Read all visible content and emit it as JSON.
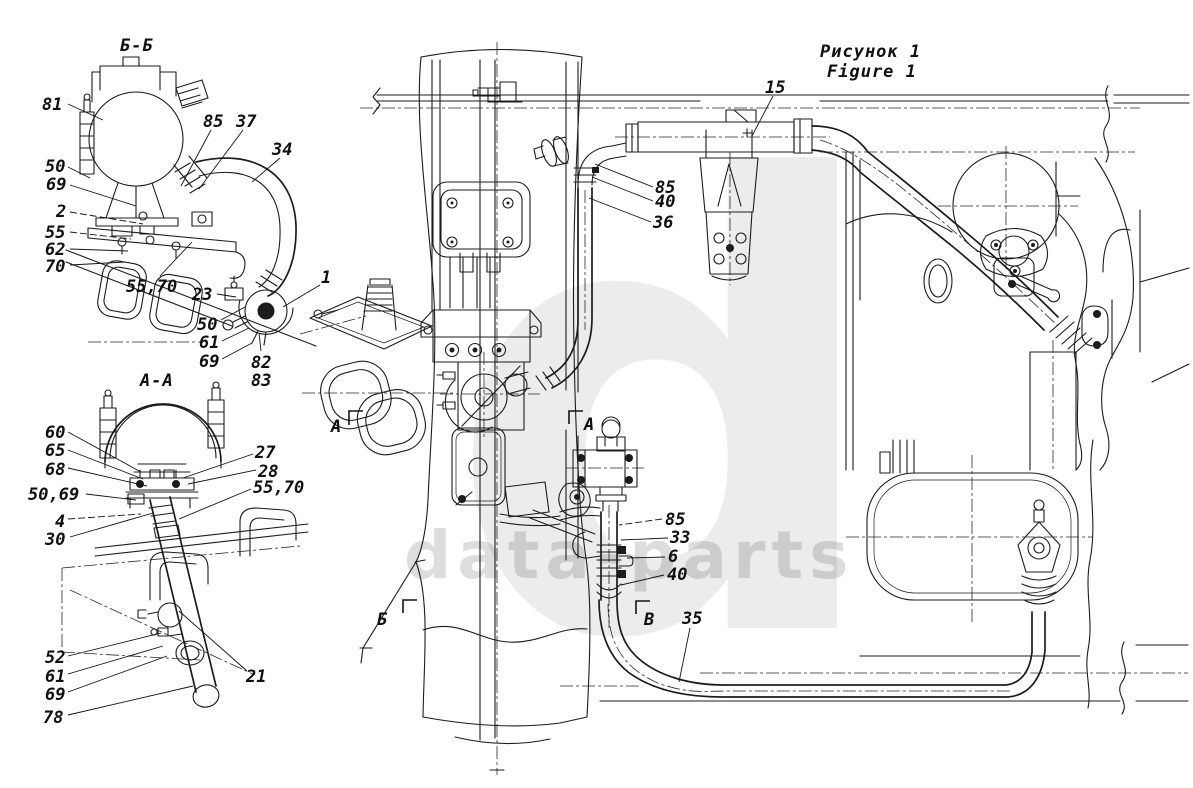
{
  "figure": {
    "title_ru": "Рисунок 1",
    "title_en": "Figure 1"
  },
  "watermark": {
    "letter": "d",
    "text": "data-parts"
  },
  "sections": {
    "bb": "Б-Б",
    "aa": "А-А"
  },
  "markers": [
    {
      "label": "А",
      "x": 331,
      "y": 432,
      "bracket": [
        [
          349,
          425
        ],
        [
          349,
          411
        ],
        [
          363,
          411
        ]
      ]
    },
    {
      "label": "А",
      "x": 584,
      "y": 430,
      "bracket": [
        [
          569,
          424
        ],
        [
          569,
          411
        ],
        [
          583,
          411
        ]
      ]
    },
    {
      "label": "Б",
      "x": 377,
      "y": 625,
      "bracket": [
        [
          403,
          613
        ],
        [
          403,
          600
        ],
        [
          417,
          600
        ]
      ]
    },
    {
      "label": "В",
      "x": 644,
      "y": 625,
      "bracket": [
        [
          636,
          614
        ],
        [
          636,
          601
        ],
        [
          650,
          601
        ]
      ]
    }
  ],
  "callouts": [
    {
      "t": "81",
      "x": 42,
      "y": 110,
      "leader": [
        [
          68,
          104
        ],
        [
          103,
          120
        ]
      ]
    },
    {
      "t": "85",
      "x": 203,
      "y": 127,
      "leader": [
        [
          211,
          130
        ],
        [
          181,
          186
        ]
      ]
    },
    {
      "t": "37",
      "x": 236,
      "y": 127,
      "leader": [
        [
          243,
          130
        ],
        [
          199,
          189
        ]
      ]
    },
    {
      "t": "34",
      "x": 272,
      "y": 155,
      "leader": [
        [
          280,
          158
        ],
        [
          252,
          182
        ]
      ]
    },
    {
      "t": "50",
      "x": 45,
      "y": 172,
      "leader": [
        [
          68,
          167
        ],
        [
          90,
          178
        ]
      ]
    },
    {
      "t": "69",
      "x": 46,
      "y": 190,
      "leader": [
        [
          70,
          185
        ],
        [
          136,
          206
        ]
      ]
    },
    {
      "t": "2",
      "x": 56,
      "y": 217,
      "leader": [
        [
          70,
          212
        ],
        [
          143,
          224
        ]
      ],
      "dash": true
    },
    {
      "t": "55",
      "x": 45,
      "y": 238,
      "leader": [
        [
          70,
          232
        ],
        [
          131,
          239
        ]
      ],
      "dash": true
    },
    {
      "t": "62",
      "x": 45,
      "y": 255,
      "leader": [
        [
          70,
          249
        ],
        [
          128,
          251
        ]
      ]
    },
    {
      "t": "70",
      "x": 45,
      "y": 272,
      "leader": [
        [
          70,
          265
        ],
        [
          126,
          262
        ]
      ]
    },
    {
      "t": "55,70",
      "x": 126,
      "y": 292,
      "leader": [
        [
          160,
          276
        ],
        [
          192,
          242
        ]
      ]
    },
    {
      "t": "23",
      "x": 192,
      "y": 300,
      "leader": [
        [
          217,
          294
        ],
        [
          236,
          297
        ]
      ]
    },
    {
      "t": "1",
      "x": 321,
      "y": 283,
      "leader": [
        [
          320,
          285
        ],
        [
          283,
          307
        ]
      ]
    },
    {
      "t": "50",
      "x": 197,
      "y": 330,
      "leader": [
        [
          221,
          320
        ],
        [
          245,
          307
        ]
      ]
    },
    {
      "t": "61",
      "x": 199,
      "y": 348,
      "leader": [
        [
          222,
          341
        ],
        [
          249,
          328
        ]
      ]
    },
    {
      "t": "69",
      "x": 199,
      "y": 367,
      "leader": [
        [
          222,
          359
        ],
        [
          252,
          343
        ]
      ]
    },
    {
      "t": "82",
      "x": 251,
      "y": 368,
      "leader": [
        [
          261,
          351
        ],
        [
          259,
          333
        ]
      ]
    },
    {
      "t": "83",
      "x": 251,
      "y": 386
    },
    {
      "t": "60",
      "x": 45,
      "y": 438,
      "leader": [
        [
          68,
          432
        ],
        [
          141,
          472
        ]
      ]
    },
    {
      "t": "65",
      "x": 45,
      "y": 456,
      "leader": [
        [
          68,
          450
        ],
        [
          143,
          479
        ]
      ]
    },
    {
      "t": "68",
      "x": 45,
      "y": 475,
      "leader": [
        [
          68,
          468
        ],
        [
          147,
          486
        ]
      ]
    },
    {
      "t": "50,69",
      "x": 28,
      "y": 500,
      "leader": [
        [
          86,
          494
        ],
        [
          136,
          500
        ]
      ]
    },
    {
      "t": "4",
      "x": 55,
      "y": 527,
      "leader": [
        [
          68,
          519
        ],
        [
          141,
          514
        ]
      ],
      "dash": true
    },
    {
      "t": "30",
      "x": 45,
      "y": 545,
      "leader": [
        [
          70,
          537
        ],
        [
          153,
          513
        ]
      ]
    },
    {
      "t": "27",
      "x": 255,
      "y": 458,
      "leader": [
        [
          253,
          454
        ],
        [
          183,
          478
        ]
      ]
    },
    {
      "t": "28",
      "x": 258,
      "y": 477,
      "leader": [
        [
          256,
          470
        ],
        [
          188,
          484
        ]
      ]
    },
    {
      "t": "55,70",
      "x": 253,
      "y": 493,
      "leader": [
        [
          251,
          489
        ],
        [
          179,
          519
        ]
      ]
    },
    {
      "t": "52",
      "x": 45,
      "y": 663,
      "leader": [
        [
          68,
          656
        ],
        [
          161,
          633
        ]
      ]
    },
    {
      "t": "61",
      "x": 45,
      "y": 682,
      "leader": [
        [
          68,
          674
        ],
        [
          163,
          646
        ]
      ]
    },
    {
      "t": "69",
      "x": 45,
      "y": 700,
      "leader": [
        [
          68,
          692
        ],
        [
          167,
          656
        ]
      ]
    },
    {
      "t": "78",
      "x": 43,
      "y": 723,
      "leader": [
        [
          68,
          715
        ],
        [
          193,
          686
        ]
      ]
    },
    {
      "t": "21",
      "x": 246,
      "y": 682,
      "leader": [
        [
          247,
          671
        ],
        [
          179,
          611
        ]
      ]
    },
    {
      "t": "15",
      "x": 765,
      "y": 93,
      "leader": [
        [
          773,
          96
        ],
        [
          752,
          136
        ]
      ]
    },
    {
      "t": "85",
      "x": 655,
      "y": 193,
      "leader": [
        [
          653,
          187
        ],
        [
          595,
          164
        ]
      ]
    },
    {
      "t": "40",
      "x": 655,
      "y": 207,
      "leader": [
        [
          653,
          201
        ],
        [
          592,
          177
        ]
      ]
    },
    {
      "t": "36",
      "x": 653,
      "y": 228,
      "leader": [
        [
          651,
          222
        ],
        [
          589,
          198
        ]
      ]
    },
    {
      "t": "85",
      "x": 665,
      "y": 525,
      "leader": [
        [
          662,
          519
        ],
        [
          619,
          525
        ]
      ],
      "dash": true
    },
    {
      "t": "33",
      "x": 670,
      "y": 543,
      "leader": [
        [
          668,
          538
        ],
        [
          621,
          540
        ]
      ]
    },
    {
      "t": "6",
      "x": 668,
      "y": 562,
      "leader": [
        [
          665,
          557
        ],
        [
          627,
          558
        ]
      ]
    },
    {
      "t": "40",
      "x": 667,
      "y": 580,
      "leader": [
        [
          664,
          575
        ],
        [
          621,
          585
        ]
      ]
    },
    {
      "t": "35",
      "x": 682,
      "y": 624,
      "leader": [
        [
          690,
          628
        ],
        [
          679,
          682
        ]
      ]
    }
  ]
}
